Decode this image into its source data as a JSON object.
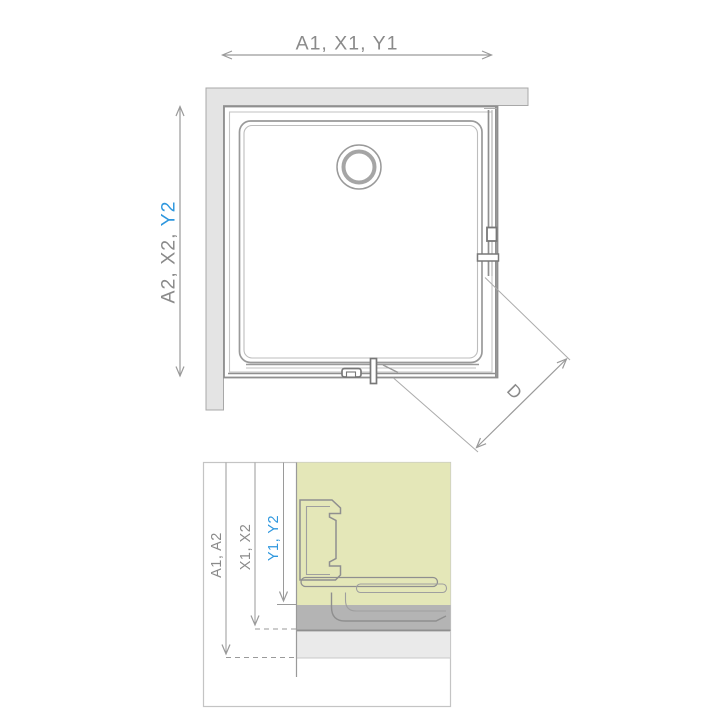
{
  "diagram": {
    "type": "technical-drawing",
    "description": "Square shower enclosure: top view with dimension lines and installation cross-section detail",
    "top_view": {
      "width_dimension": "A1, X1, Y1",
      "depth_dimension_gray": "A2, X2, ",
      "depth_dimension_blue": "Y2",
      "diagonal_dimension": "D"
    },
    "detail_view": {
      "dimension_outer": "A1, A2",
      "dimension_middle": "X1, X2",
      "dimension_inner": "Y1, Y2"
    }
  },
  "colors": {
    "background": "#FFFFFF",
    "dimension_gray_text": "#8A8A8A",
    "accent_blue": "#2E97DE",
    "wall_fill": "#E4E4E4",
    "wall_stroke": "#A8A8A8",
    "line_gray": "#8F8F8F",
    "highlight_yellow": "#E4E7B8",
    "band_dark_gray": "#B4B4B4",
    "band_light_gray": "#EAEAEA",
    "panel_white": "#FFFFFF"
  }
}
